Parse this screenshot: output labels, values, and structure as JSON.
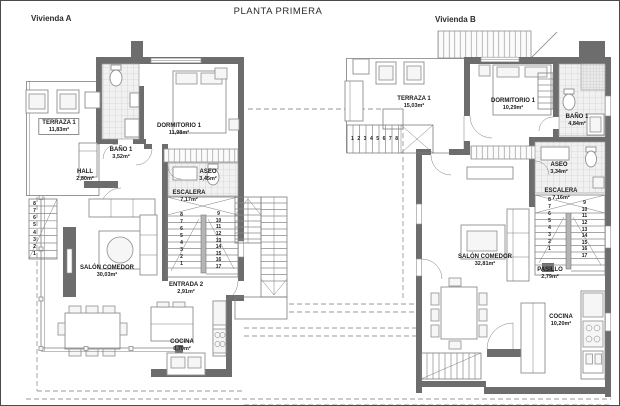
{
  "title": "PLANTA PRIMERA",
  "houses": {
    "a": {
      "label": "Vivienda A",
      "rooms": {
        "terraza": {
          "name": "TERRAZA 1",
          "area": "11,83m²"
        },
        "bano": {
          "name": "BAÑO 1",
          "area": "3,52m²"
        },
        "dormitorio": {
          "name": "DORMITORIO 1",
          "area": "11,98m²"
        },
        "hall": {
          "name": "HALL",
          "area": "2,80m²"
        },
        "aseo": {
          "name": "ASEO",
          "area": "3,45m²"
        },
        "escalera": {
          "name": "ESCALERA",
          "area": "7,17m²"
        },
        "entrada": {
          "name": "ENTRADA 2",
          "area": "2,91m²"
        },
        "salon": {
          "name": "SALÓN COMEDOR",
          "area": "30,03m²"
        },
        "cocina": {
          "name": "COCINA",
          "area": "8,70m²"
        }
      },
      "stairs": {
        "left_flight": [
          "1",
          "2",
          "3",
          "4",
          "5",
          "6",
          "7",
          "8"
        ],
        "right_flight": [
          "9",
          "10",
          "11",
          "12",
          "13",
          "14",
          "15",
          "16",
          "17"
        ],
        "exterior": [
          "8",
          "7",
          "6",
          "5",
          "4",
          "3",
          "2",
          "1"
        ]
      }
    },
    "b": {
      "label": "Vivienda B",
      "rooms": {
        "terraza": {
          "name": "TERRAZA 1",
          "area": "15,03m²"
        },
        "dormitorio": {
          "name": "DORMITORIO 1",
          "area": "10,29m²"
        },
        "bano": {
          "name": "BAÑO 1",
          "area": "4,84m²"
        },
        "aseo": {
          "name": "ASEO",
          "area": "3,34m²"
        },
        "escalera": {
          "name": "ESCALERA",
          "area": "7,16m²"
        },
        "pasillo": {
          "name": "PASILLO",
          "area": "2,79m²"
        },
        "salon": {
          "name": "SALÓN COMEDOR",
          "area": "32,81m²"
        },
        "cocina": {
          "name": "COCINA",
          "area": "10,20m²"
        }
      },
      "stairs": {
        "left_flight": [
          "1",
          "2",
          "3",
          "4",
          "5",
          "6",
          "7",
          "8"
        ],
        "right_flight": [
          "9",
          "10",
          "11",
          "12",
          "13",
          "14",
          "15",
          "16",
          "17"
        ],
        "exterior": [
          "1",
          "2",
          "3",
          "4",
          "5",
          "6",
          "7",
          "8"
        ]
      }
    }
  },
  "colors": {
    "wall": "#6d6d6d",
    "line": "#7d7d7d",
    "dash": "#9a9a9a",
    "text": "#1c1c1c"
  }
}
